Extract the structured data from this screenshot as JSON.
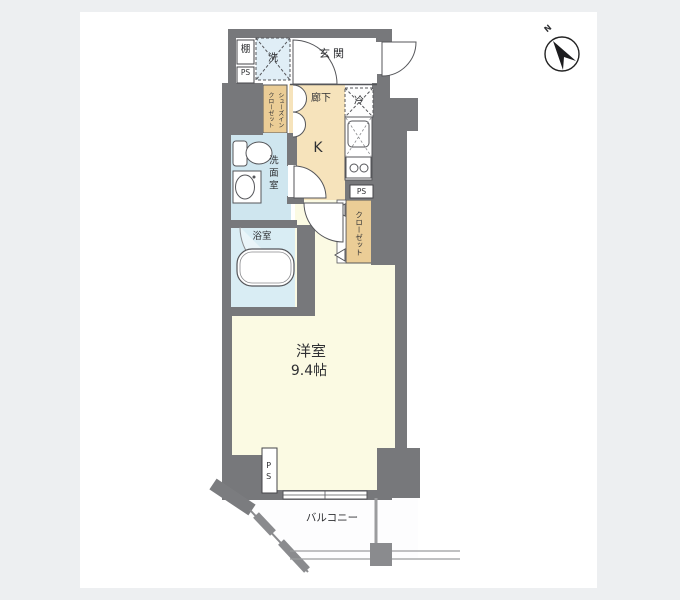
{
  "areas": {
    "entrance": {
      "label": "玄関"
    },
    "hallway": {
      "label": "廊下"
    },
    "kitchen": {
      "label": "K"
    },
    "washroom": {
      "label": "洗面室"
    },
    "bathroom": {
      "label": "浴室"
    },
    "main_room": {
      "label": "洋室",
      "size": "9.4帖"
    },
    "balcony": {
      "label": "バルコニー"
    },
    "closet": {
      "label": "クローゼット"
    },
    "shoe_closet": {
      "label": "シューズインクローゼット",
      "line1": "シューズイン",
      "line2": "クローゼット"
    }
  },
  "features": {
    "shelf": {
      "label": "棚"
    },
    "washer": {
      "label": "洗"
    },
    "fridge": {
      "label": "冷"
    },
    "ps_top": {
      "label": "PS"
    },
    "ps_kitchen": {
      "label": "PS"
    },
    "ps_bottom": {
      "label": "PS"
    }
  },
  "compass": {
    "north_label": "N"
  },
  "colors": {
    "page_background": "#edeff1",
    "plan_background": "#ffffff",
    "wall": "#77787b",
    "main_room_floor": "#fbfae3",
    "hallway_floor": "#f6e3bb",
    "closet_floor": "#ebcd96",
    "washroom_floor": "#cfe6ef",
    "bathroom_floor": "#d9edf4",
    "washer_box": "#e0eef6",
    "balcony_floor": "#fdfdfe",
    "outline": "#55565a"
  }
}
